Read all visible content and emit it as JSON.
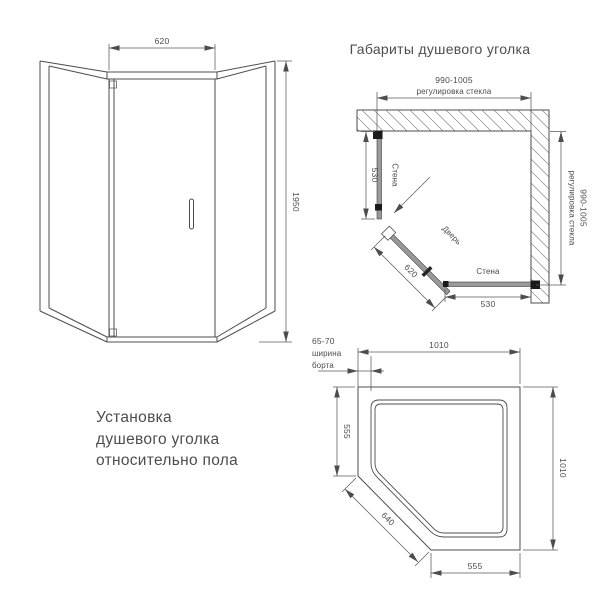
{
  "colors": {
    "background": "#ffffff",
    "line": "#4d4d4d",
    "dim_line": "#5a5a5a",
    "glass_fill": "#9a9a9a",
    "profile_black": "#1a1a1a",
    "hatch": "#8a8a8a"
  },
  "front_view": {
    "width_dim": "620",
    "height_dim": "1950"
  },
  "plan_view": {
    "title": "Габариты душевого уголка",
    "top_dim_value": "990-1005",
    "top_dim_note": "регулировка стекла",
    "right_dim_value": "990-1005",
    "right_dim_note": "регулировка стекла",
    "left_glass_dim": "530",
    "left_glass_label": "Стена",
    "bottom_glass_dim": "530",
    "bottom_glass_label": "Стена",
    "door_label": "Дверь",
    "door_dim": "620"
  },
  "tray_view": {
    "rim_note_1": "65-70",
    "rim_note_2": "ширина",
    "rim_note_3": "борта",
    "top_dim": "1010",
    "left_dim": "555",
    "diag_dim": "640",
    "bottom_dim": "555",
    "right_dim": "1010"
  },
  "caption": {
    "line1": "Установка",
    "line2": "душевого уголка",
    "line3": "относительно пола"
  }
}
